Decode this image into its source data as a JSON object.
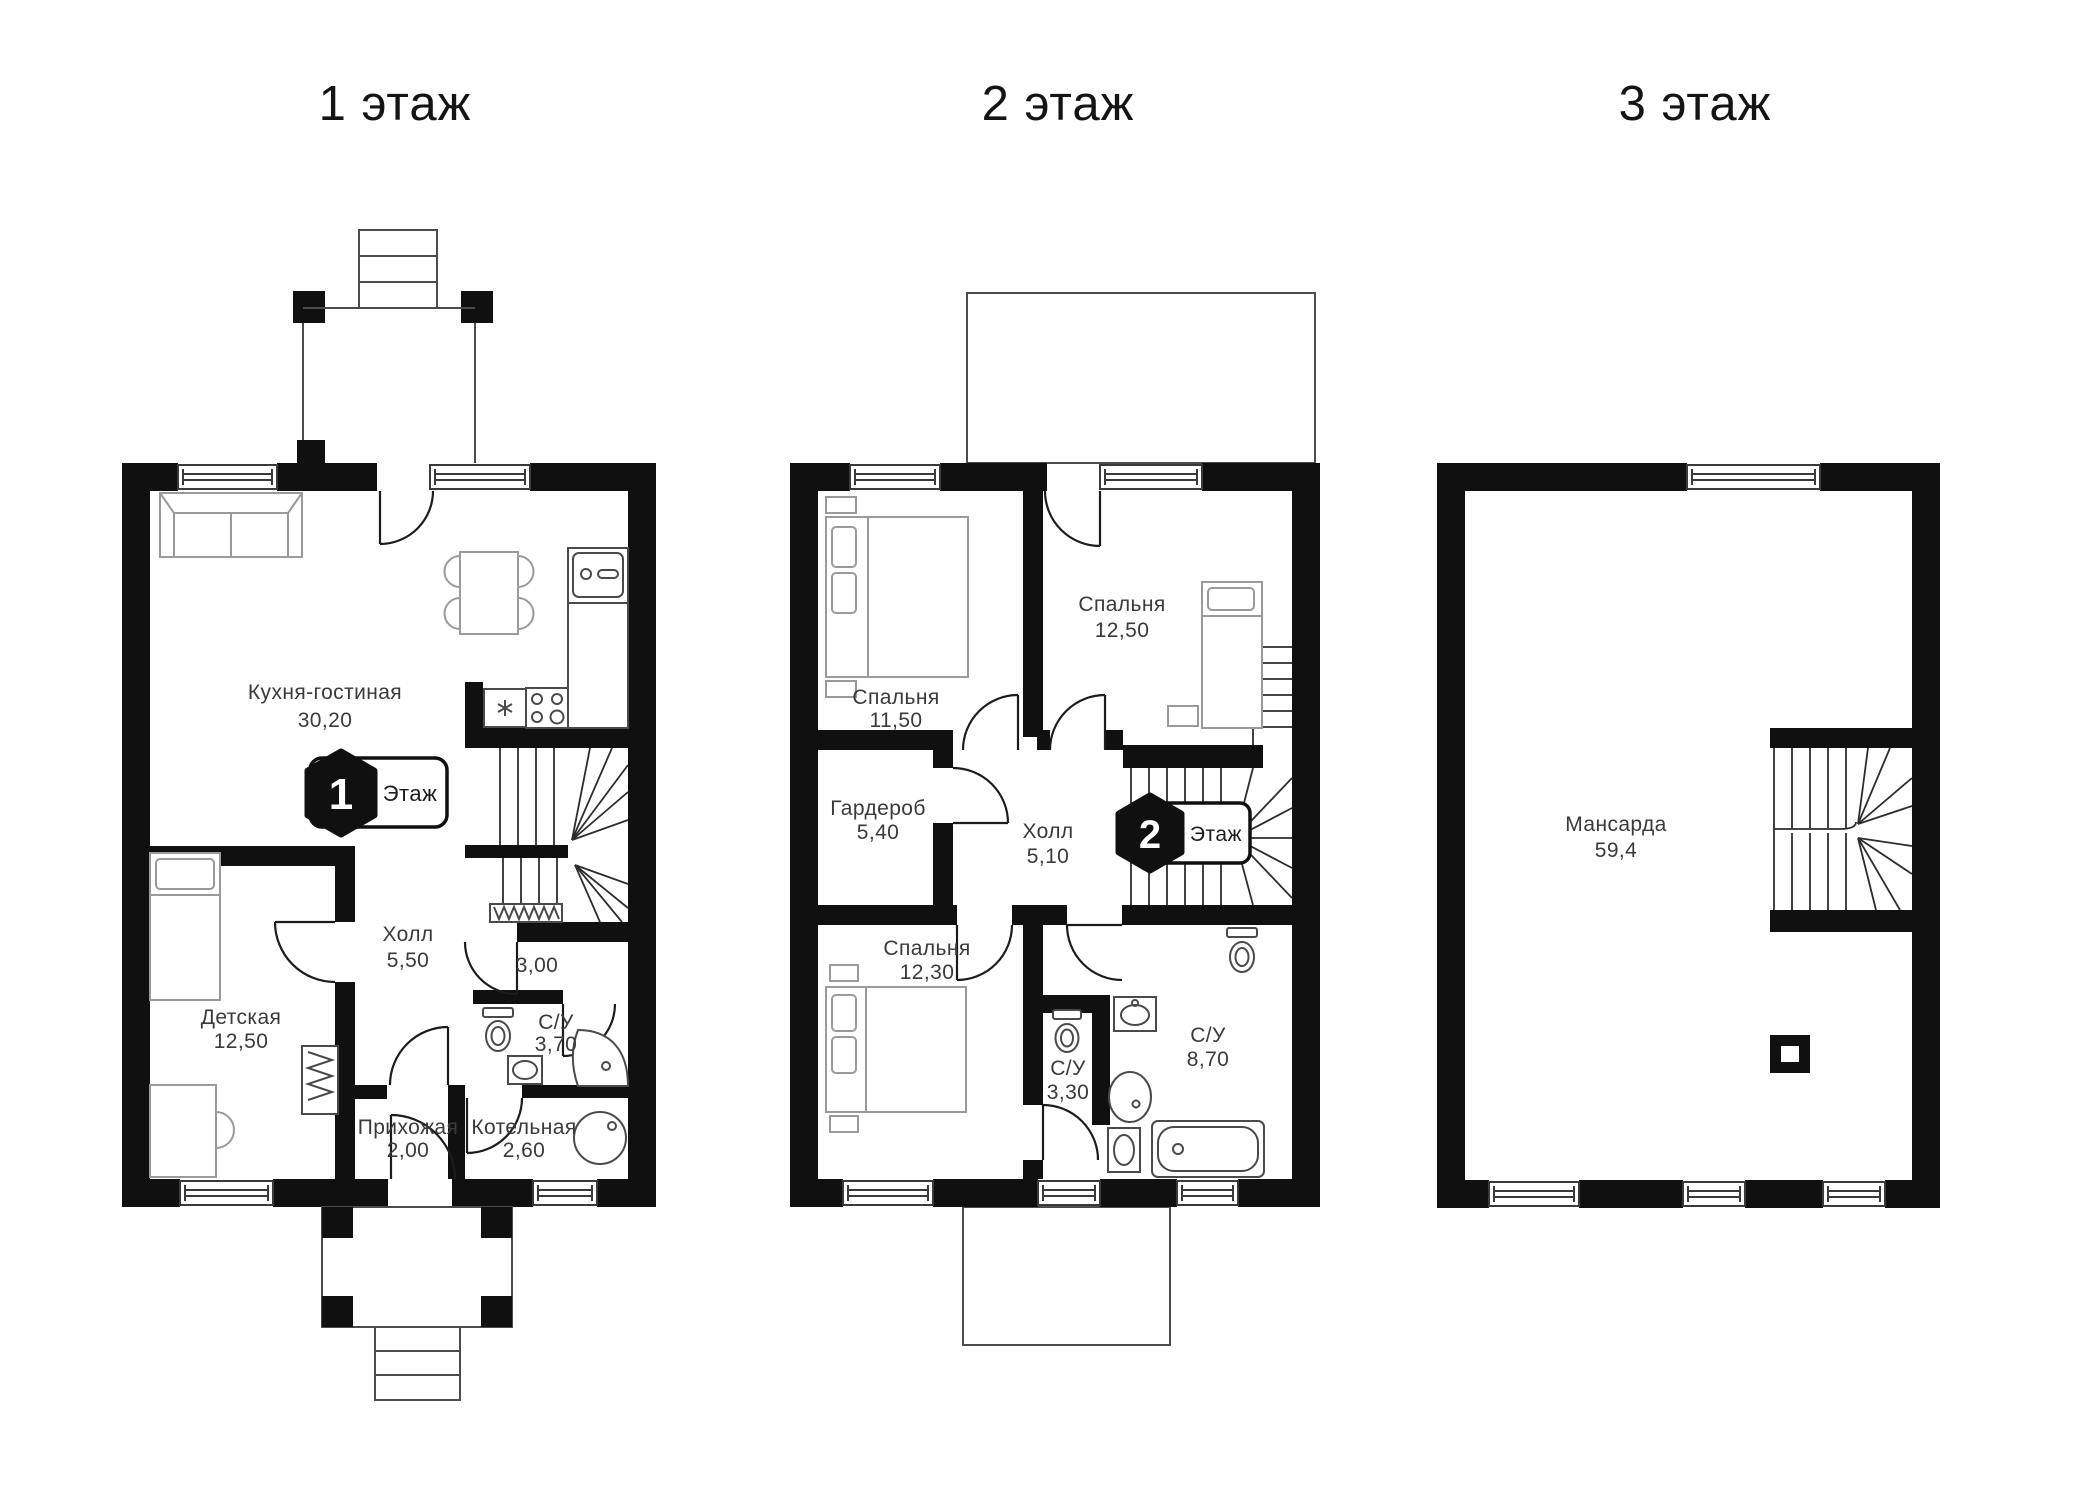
{
  "floors": [
    {
      "title": "1 этаж",
      "badge": {
        "number": "1",
        "label": "Этаж"
      },
      "rooms": [
        {
          "name": "Кухня-гостиная",
          "area": "30,20"
        },
        {
          "name": "Холл",
          "area": "5,50"
        },
        {
          "name": "",
          "area": "3,00"
        },
        {
          "name": "Детская",
          "area": "12,50"
        },
        {
          "name": "С/У",
          "area": "3,70"
        },
        {
          "name": "Прихожая",
          "area": "2,00"
        },
        {
          "name": "Котельная",
          "area": "2,60"
        }
      ]
    },
    {
      "title": "2 этаж",
      "badge": {
        "number": "2",
        "label": "Этаж"
      },
      "rooms": [
        {
          "name": "Спальня",
          "area": "11,50"
        },
        {
          "name": "Спальня",
          "area": "12,50"
        },
        {
          "name": "Гардероб",
          "area": "5,40"
        },
        {
          "name": "Холл",
          "area": "5,10"
        },
        {
          "name": "Спальня",
          "area": "12,30"
        },
        {
          "name": "С/У",
          "area": "3,30"
        },
        {
          "name": "С/У",
          "area": "8,70"
        }
      ]
    },
    {
      "title": "3 этаж",
      "rooms": [
        {
          "name": "Мансарда",
          "area": "59,4"
        }
      ]
    }
  ],
  "colors": {
    "wall": "#101010",
    "text": "#3a3a3a",
    "title": "#141414",
    "bg": "#ffffff"
  }
}
